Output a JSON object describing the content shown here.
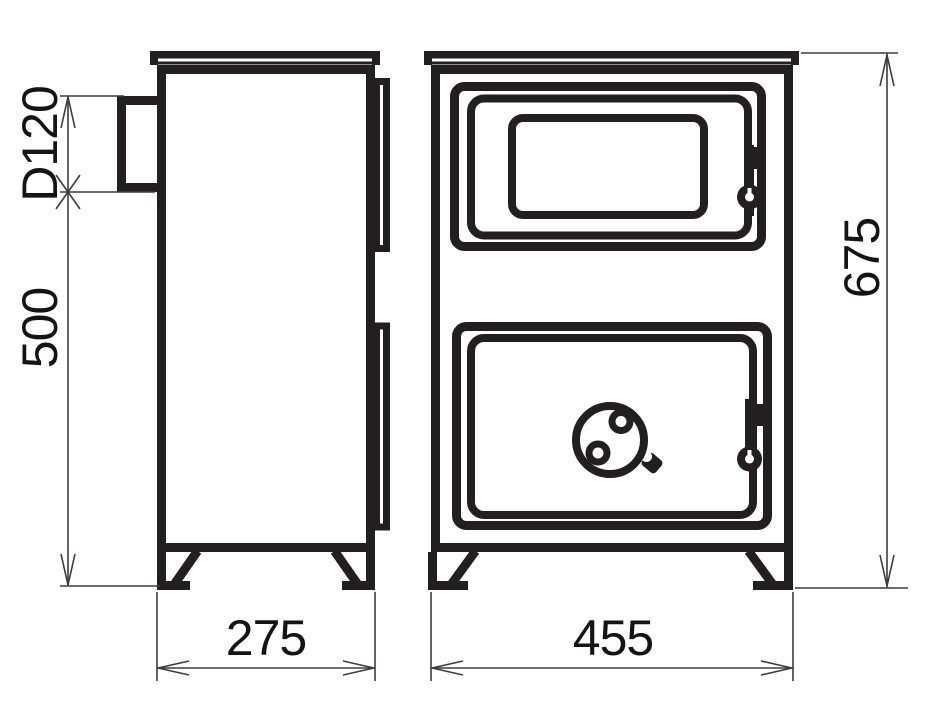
{
  "drawing": {
    "type": "technical-drawing",
    "subject": "stove-two-view-dimensioned",
    "colors": {
      "background": "#ffffff",
      "line": "#231f20",
      "dimension_line": "#3f3b3c",
      "dimension_text": "#161314"
    },
    "views": {
      "side": {
        "label_parts": [
          "top-plate",
          "flue-collar",
          "body",
          "door-edges",
          "legs"
        ]
      },
      "front": {
        "label_parts": [
          "top-plate",
          "body",
          "upper-door-with-window",
          "lower-door",
          "air-control-knob",
          "latches",
          "legs"
        ]
      }
    },
    "dimensions": {
      "flue_diameter": "D120",
      "flue_to_floor_height": "500",
      "depth": "275",
      "width": "455",
      "overall_height": "675"
    }
  }
}
